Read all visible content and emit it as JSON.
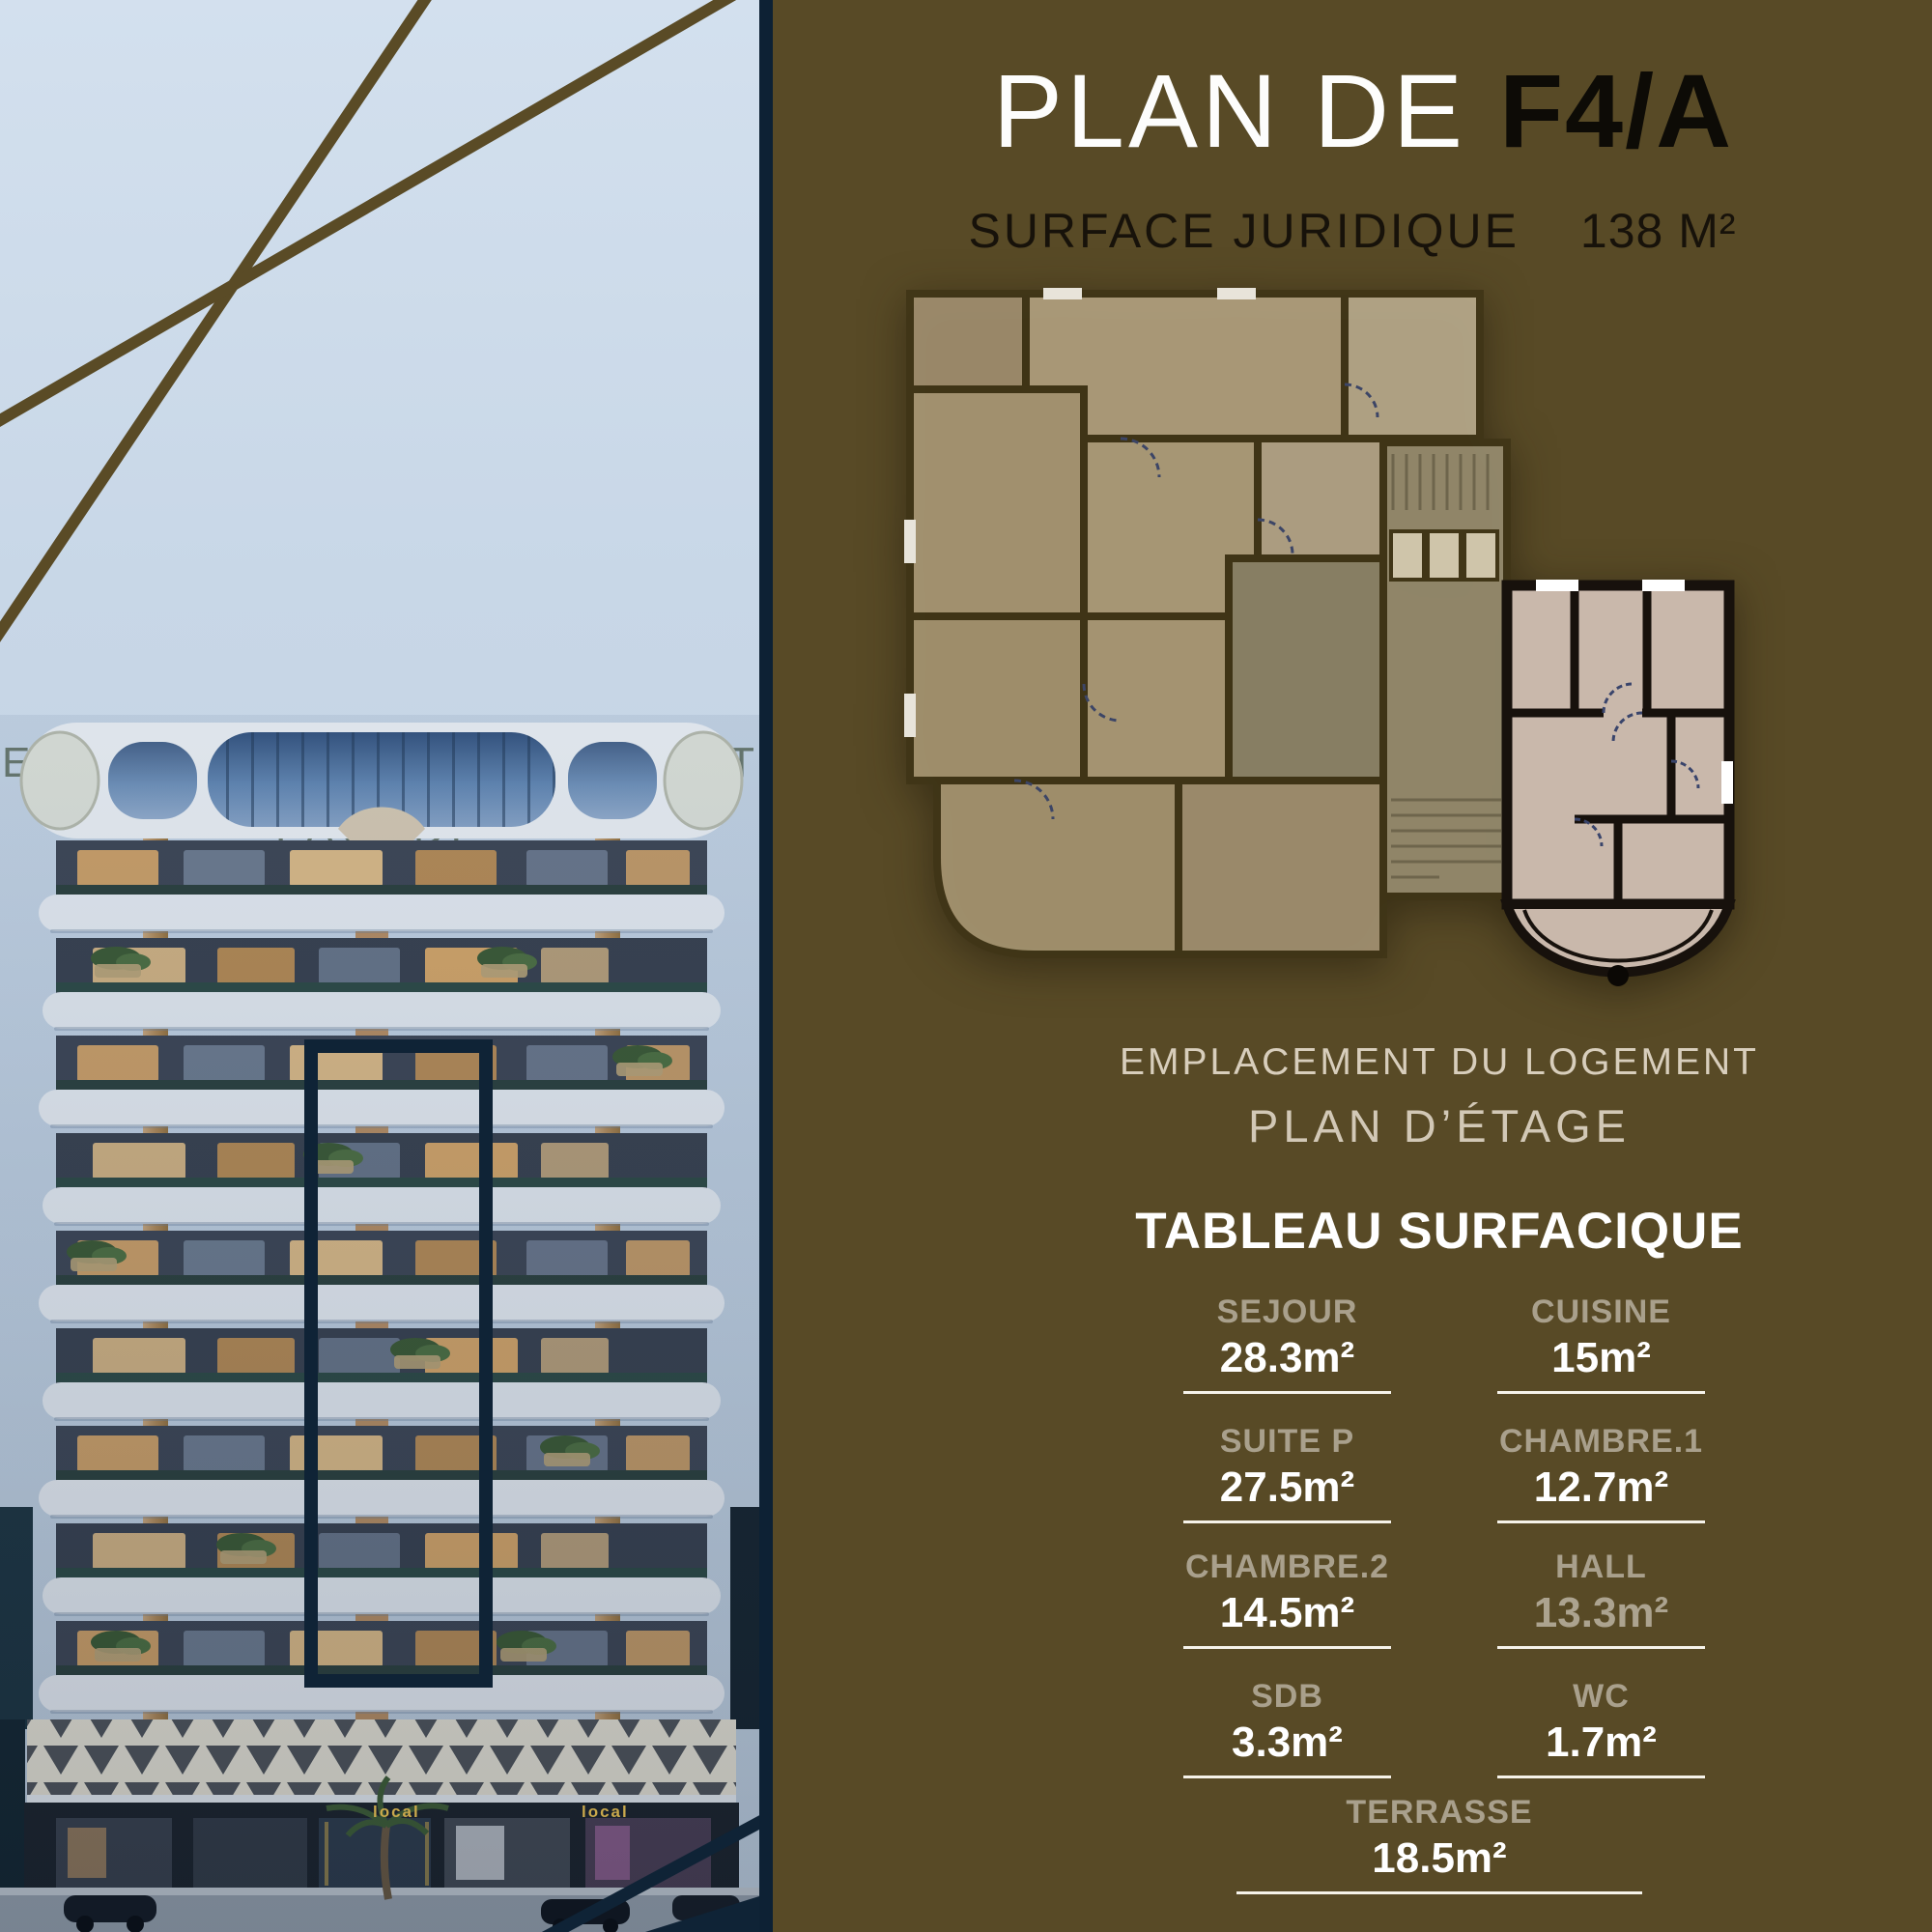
{
  "left_panel": {
    "location_title": "EMPLACEMENT DU LOGEMENT",
    "view_label": "FAÇADE",
    "storefront_signs": [
      "local",
      "local"
    ]
  },
  "right_panel": {
    "title_prefix": "PLAN DE ",
    "title_unit": "F4/A",
    "surface_label": "SURFACE JURIDIQUE",
    "surface_value": "138 M²",
    "plan_caption_line1": "EMPLACEMENT DU LOGEMENT",
    "plan_caption_line2": "PLAN D’ÉTAGE",
    "table_title": "TABLEAU SURFACIQUE",
    "rooms": [
      {
        "name": "SEJOUR",
        "area": "28.3m²"
      },
      {
        "name": "CUISINE",
        "area": "15m²"
      },
      {
        "name": "SUITE P",
        "area": "27.5m²"
      },
      {
        "name": "CHAMBRE.1",
        "area": "12.7m²"
      },
      {
        "name": "CHAMBRE.2",
        "area": "14.5m²"
      },
      {
        "name": "HALL",
        "area": "13.3m²"
      },
      {
        "name": "SDB",
        "area": "3.3m²"
      },
      {
        "name": "WC",
        "area": "1.7m²"
      },
      {
        "name": "TERRASSE",
        "area": "18.5m²"
      }
    ]
  },
  "colors": {
    "olive_background": "#584a26",
    "navy_accent": "#0f2336",
    "sky": "#c6d5e5",
    "muted_label": "#a9a08c",
    "value_white": "#ffffff",
    "gold_line": "#5a4b26",
    "plan_mass_fill": "#ab9a77",
    "plan_unit_fill": "#c9b8ab",
    "shop_sign_gold": "#c9a84c"
  }
}
